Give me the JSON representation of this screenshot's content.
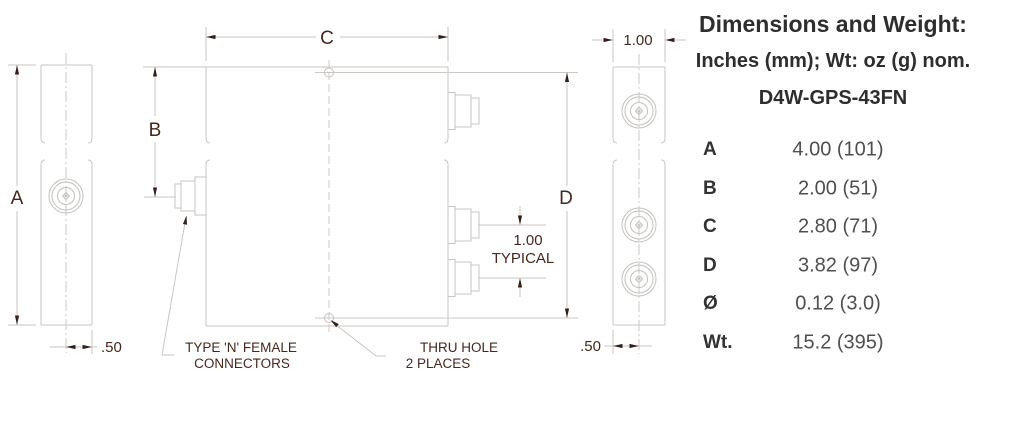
{
  "drawing": {
    "dims": {
      "a": "A",
      "b": "B",
      "c": "C",
      "d": "D"
    },
    "left_view_offset": ".50",
    "right_view_width": "1.00",
    "right_view_offset": ".50",
    "typical": {
      "value": "1.00",
      "word": "TYPICAL"
    },
    "connector_note": {
      "line1": "TYPE 'N' FEMALE",
      "line2": "CONNECTORS"
    },
    "hole_note": {
      "line1": "THRU HOLE",
      "line2": "2 PLACES"
    },
    "colors": {
      "outline": "#c8c5c0",
      "centerline": "#ccc9c4",
      "dim_text": "#46281e",
      "arrow": "#35211a"
    }
  },
  "panel": {
    "title": "Dimensions and Weight:",
    "subtitle": "Inches (mm); Wt: oz (g) nom.",
    "model": "D4W-GPS-43FN",
    "rows": [
      {
        "label": "A",
        "value": "4.00 (101)"
      },
      {
        "label": "B",
        "value": "2.00 (51)"
      },
      {
        "label": "C",
        "value": "2.80 (71)"
      },
      {
        "label": "D",
        "value": "3.82 (97)"
      },
      {
        "label": "Ø",
        "value": "0.12 (3.0)"
      },
      {
        "label": "Wt.",
        "value": "15.2 (395)"
      }
    ]
  }
}
